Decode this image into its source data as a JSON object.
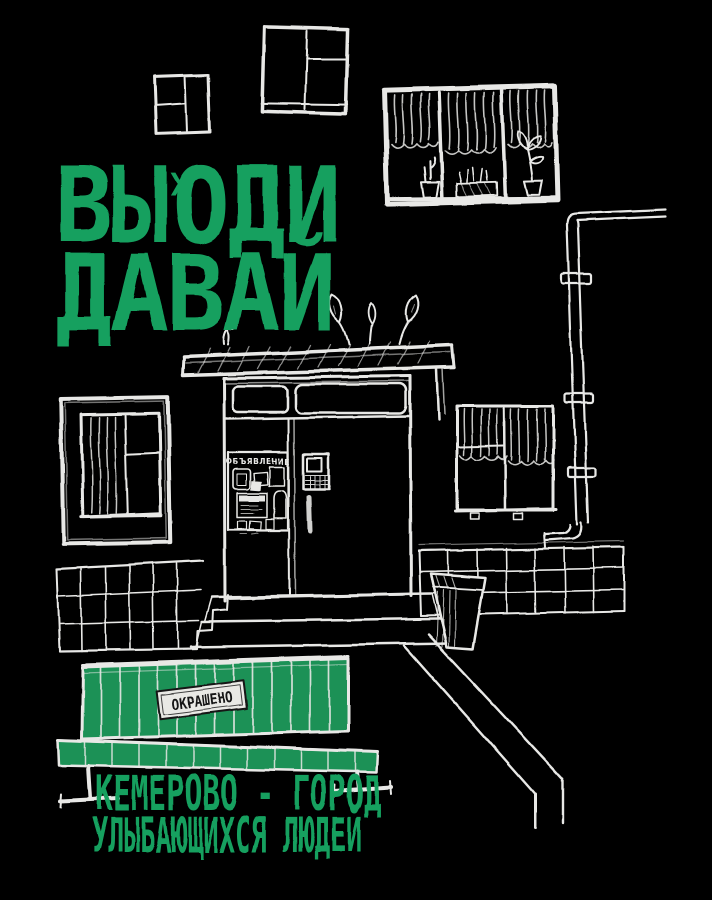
{
  "poster": {
    "colors": {
      "background": "#000000",
      "ink": "#e8e8e6",
      "green": "#14a05f",
      "bench_green": "#1b9156",
      "paper": "#e9e9e5",
      "sign_text": "#161616"
    },
    "title": {
      "part1": "ВЫ",
      "sup": "Х",
      "part2": "ОДИ",
      "line2": "ДАВАЙ"
    },
    "door_board": {
      "title": "ОБЪЯВЛЕНИЕ"
    },
    "bench": {
      "sign": "ОКРАШЕНО"
    },
    "caption": {
      "line1": "КЕМЕРОВО - ГОРОД",
      "line2": "УЛЫБАЮЩИХСЯ ЛЮДЕЙ"
    }
  }
}
